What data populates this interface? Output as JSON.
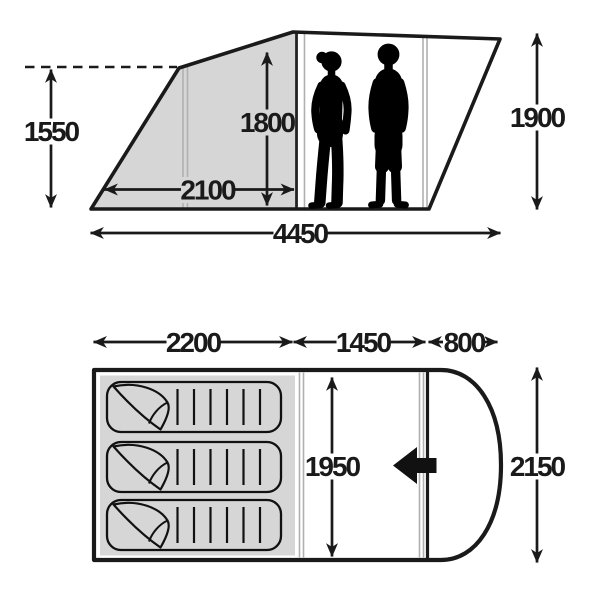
{
  "meta": {
    "description": "Tent dimensions diagram: side elevation with two adult silhouettes and floor plan with three sleeping bags",
    "units": "mm"
  },
  "colors": {
    "line": "#1a1a1a",
    "shaded_area": "#d6d6d6",
    "seam_line": "#b0b0b0",
    "silhouette": "#000000",
    "background": "#ffffff"
  },
  "side_view": {
    "front_height": "1550",
    "interior_height": "1800",
    "bedroom_length": "2100",
    "total_length": "4450",
    "peak_height": "1900"
  },
  "floor_plan": {
    "bedroom_width": "2200",
    "living_area_width": "1450",
    "porch_width": "800",
    "interior_depth": "1950",
    "total_depth": "2150"
  },
  "icons": {
    "door_arrow": "solid-left-arrow",
    "figures": "two-adult-silhouettes",
    "sleeping_bag": "sleeping-bag-top-view",
    "sleeping_bag_count": 3
  }
}
